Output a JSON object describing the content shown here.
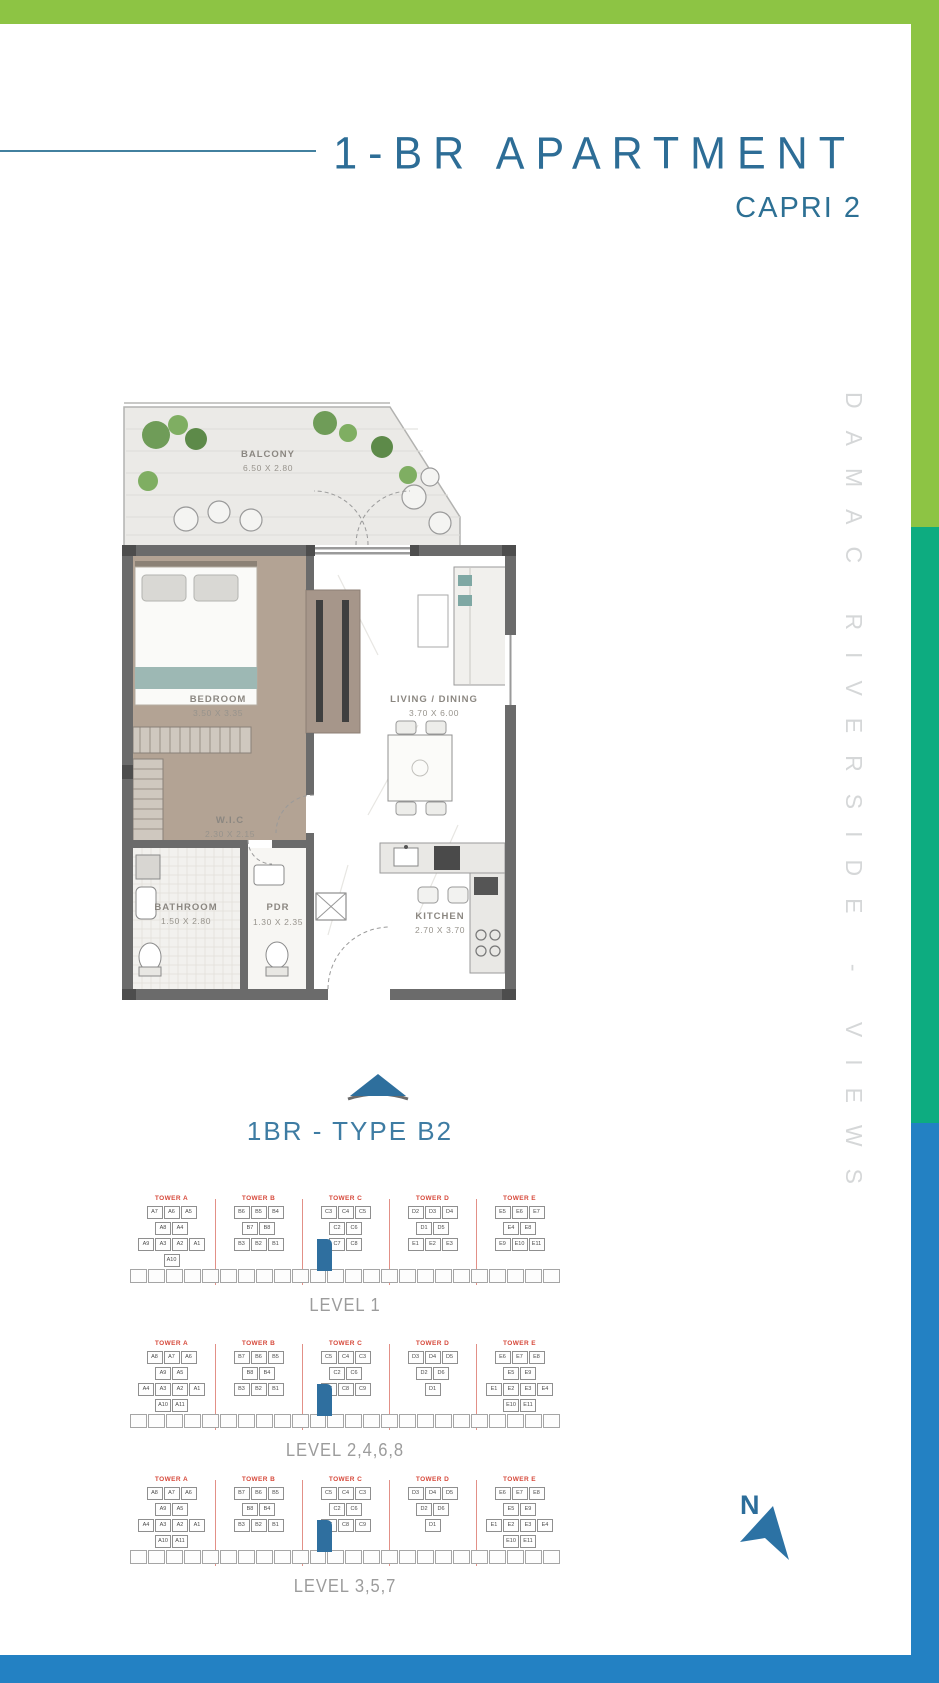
{
  "page": {
    "title": "1-BR APARTMENT",
    "subtitle": "CAPRI 2",
    "plan_name": "1BR - TYPE B2",
    "brand_vertical": "DAMAC RIVERSIDE - VIEWS",
    "north_label": "N"
  },
  "colors": {
    "green_bar": "#8dc444",
    "emerald_bar": "#0dac80",
    "blue_bar": "#2381c3",
    "title_teal": "#2d6d96",
    "plan_name_teal": "#3e7ca3",
    "tower_red": "#d6493b",
    "highlight_unit_blue": "#2f6f9f",
    "wall_gray": "#6b6b6b",
    "brand_text_gray": "#d5d7d8"
  },
  "floor_plan": {
    "rooms": [
      {
        "name": "BALCONY",
        "dims": "6.50 X 2.80"
      },
      {
        "name": "BEDROOM",
        "dims": "3.50 X 3.35"
      },
      {
        "name": "LIVING / DINING",
        "dims": "3.70 X 6.00"
      },
      {
        "name": "W.I.C",
        "dims": "2.30 X 2.15"
      },
      {
        "name": "BATHROOM",
        "dims": "1.50 X 2.80"
      },
      {
        "name": "PDR",
        "dims": "1.30 X 2.35"
      },
      {
        "name": "KITCHEN",
        "dims": "2.70 X 3.70"
      }
    ]
  },
  "levels": [
    {
      "caption": "LEVEL 1",
      "top": 1195,
      "towers": [
        {
          "name": "TOWER A",
          "rows": [
            [
              "A7",
              "A6",
              "A5"
            ],
            [
              "A8",
              "A4"
            ],
            [
              "A9",
              "A3",
              "A2",
              "A1"
            ],
            [
              "A10"
            ]
          ]
        },
        {
          "name": "TOWER B",
          "rows": [
            [
              "B6",
              "B5",
              "B4"
            ],
            [
              "B7",
              "B8"
            ],
            [
              "B3",
              "B2",
              "B1"
            ]
          ]
        },
        {
          "name": "TOWER C",
          "rows": [
            [
              "C3",
              "C4",
              "C5"
            ],
            [
              "C2",
              "C6"
            ],
            [
              "C7",
              "C8"
            ]
          ]
        },
        {
          "name": "TOWER D",
          "rows": [
            [
              "D2",
              "D3",
              "D4"
            ],
            [
              "D1",
              "D5"
            ],
            [
              "E1",
              "E2",
              "E3"
            ]
          ]
        },
        {
          "name": "TOWER E",
          "rows": [
            [
              "E5",
              "E6",
              "E7"
            ],
            [
              "E4",
              "E8"
            ],
            [
              "E9",
              "E10",
              "E11"
            ]
          ]
        }
      ]
    },
    {
      "caption": "LEVEL 2,4,6,8",
      "top": 1340,
      "towers": [
        {
          "name": "TOWER A",
          "rows": [
            [
              "A8",
              "A7",
              "A6"
            ],
            [
              "A9",
              "A5"
            ],
            [
              "A4",
              "A3",
              "A2",
              "A1"
            ],
            [
              "A10",
              "A11"
            ]
          ]
        },
        {
          "name": "TOWER B",
          "rows": [
            [
              "B7",
              "B6",
              "B5"
            ],
            [
              "B8",
              "B4"
            ],
            [
              "B3",
              "B2",
              "B1"
            ]
          ]
        },
        {
          "name": "TOWER C",
          "rows": [
            [
              "C5",
              "C4",
              "C3"
            ],
            [
              "C2",
              "C6"
            ],
            [
              "C7",
              "C8",
              "C9"
            ]
          ]
        },
        {
          "name": "TOWER D",
          "rows": [
            [
              "D3",
              "D4",
              "D5"
            ],
            [
              "D2",
              "D6"
            ],
            [
              "D1"
            ]
          ]
        },
        {
          "name": "TOWER E",
          "rows": [
            [
              "E6",
              "E7",
              "E8"
            ],
            [
              "E5",
              "E9"
            ],
            [
              "E1",
              "E2",
              "E3",
              "E4"
            ],
            [
              "E10",
              "E11"
            ]
          ]
        }
      ]
    },
    {
      "caption": "LEVEL 3,5,7",
      "top": 1476,
      "towers": [
        {
          "name": "TOWER A",
          "rows": [
            [
              "A8",
              "A7",
              "A6"
            ],
            [
              "A9",
              "A5"
            ],
            [
              "A4",
              "A3",
              "A2",
              "A1"
            ],
            [
              "A10",
              "A11"
            ]
          ]
        },
        {
          "name": "TOWER B",
          "rows": [
            [
              "B7",
              "B6",
              "B5"
            ],
            [
              "B8",
              "B4"
            ],
            [
              "B3",
              "B2",
              "B1"
            ]
          ]
        },
        {
          "name": "TOWER C",
          "rows": [
            [
              "C5",
              "C4",
              "C3"
            ],
            [
              "C2",
              "C6"
            ],
            [
              "C7",
              "C8",
              "C9"
            ]
          ]
        },
        {
          "name": "TOWER D",
          "rows": [
            [
              "D3",
              "D4",
              "D5"
            ],
            [
              "D2",
              "D6"
            ],
            [
              "D1"
            ]
          ]
        },
        {
          "name": "TOWER E",
          "rows": [
            [
              "E6",
              "E7",
              "E8"
            ],
            [
              "E5",
              "E9"
            ],
            [
              "E1",
              "E2",
              "E3",
              "E4"
            ],
            [
              "E10",
              "E11"
            ]
          ]
        }
      ]
    }
  ]
}
